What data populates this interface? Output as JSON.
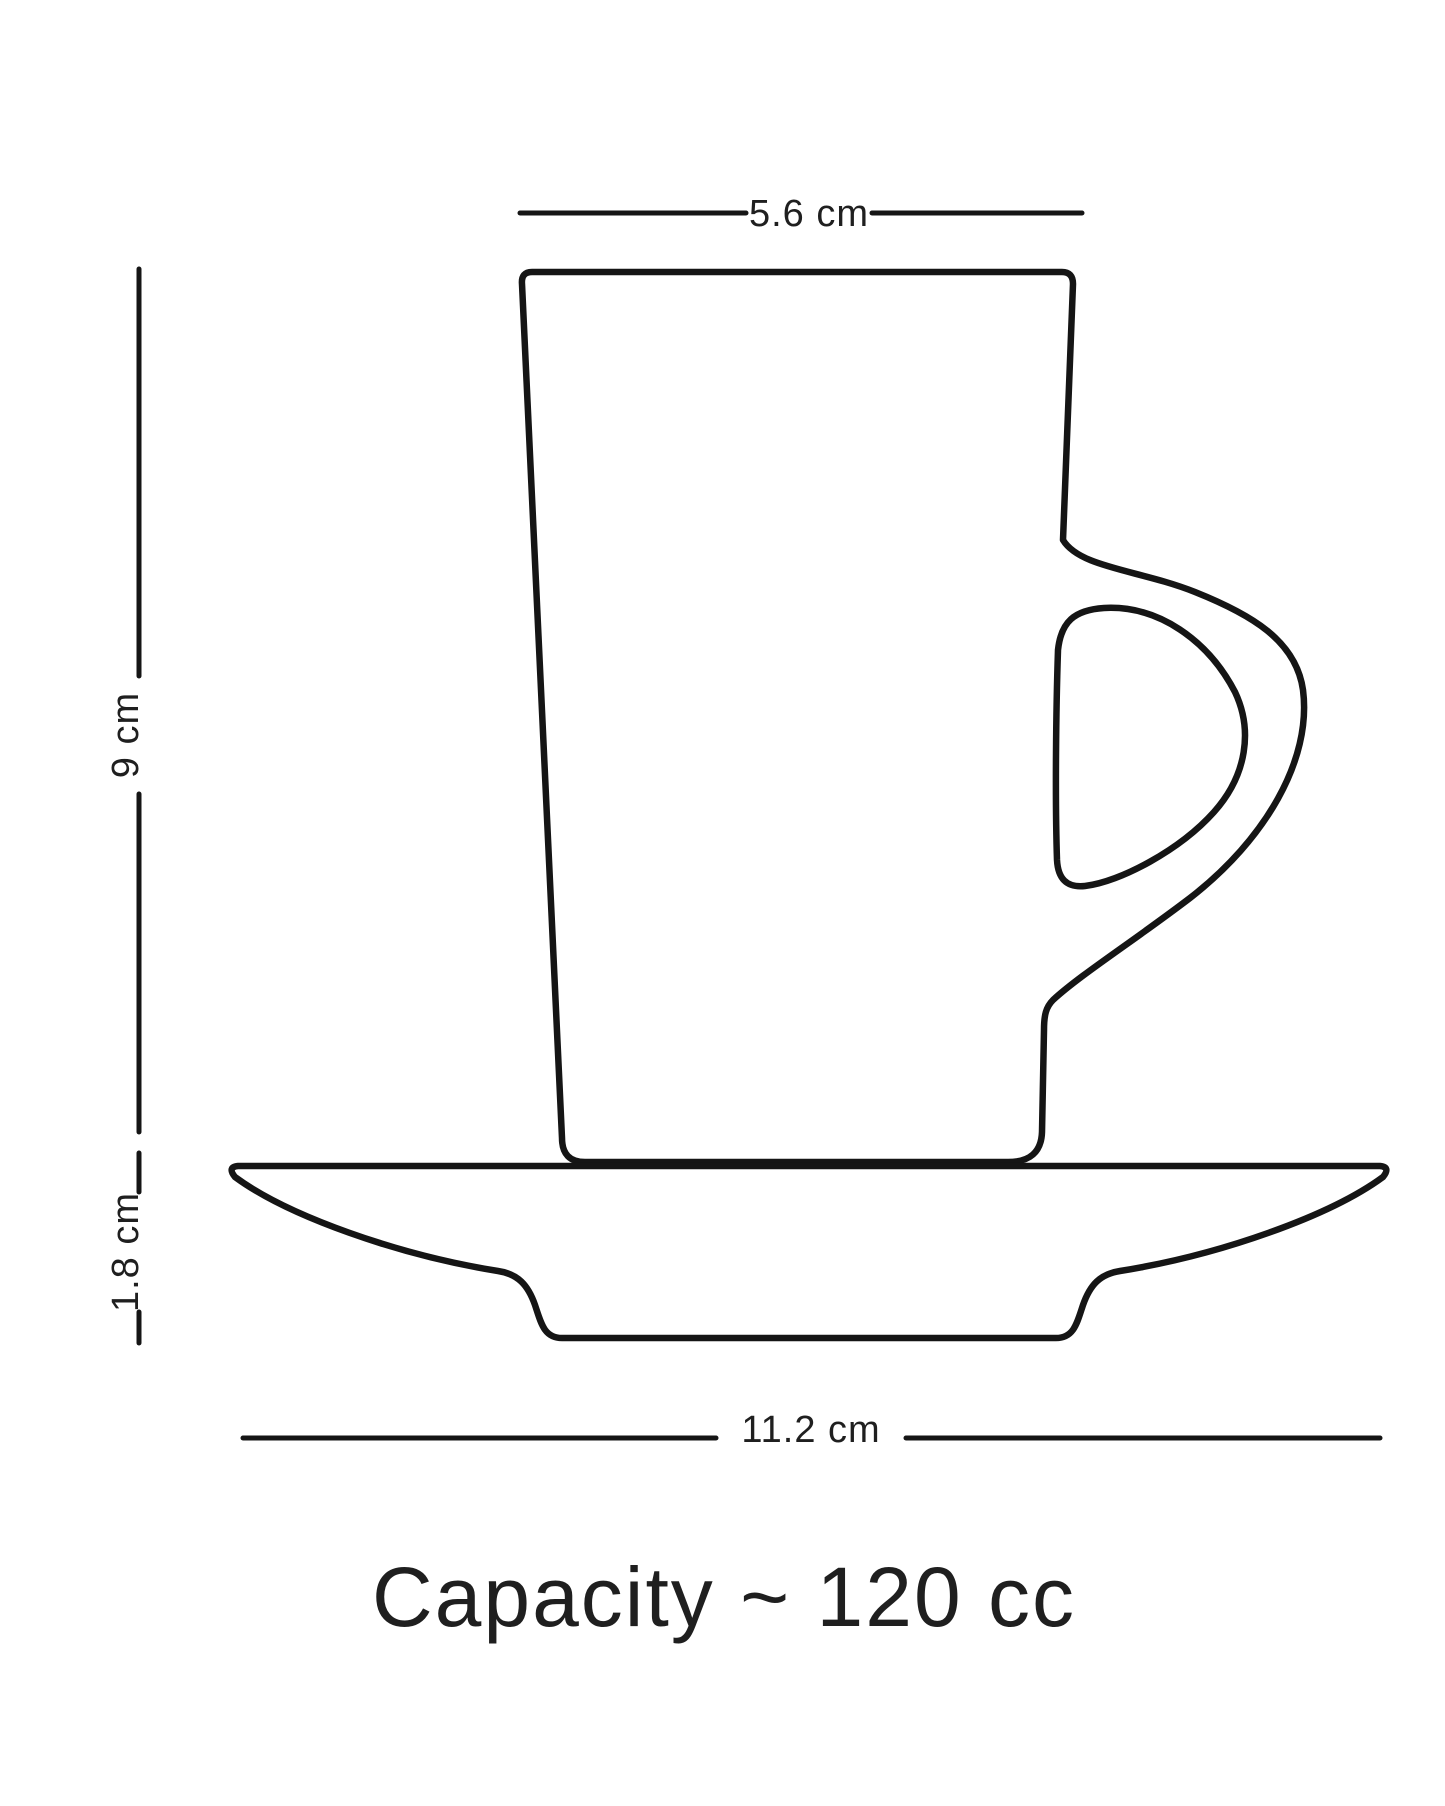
{
  "page": {
    "background": "#ffffff"
  },
  "diagram": {
    "type": "product-dimension-drawing",
    "subject": "espresso cup with saucer",
    "labels": {
      "cup_width": "5.6 cm",
      "cup_height": "9 cm",
      "saucer_height": "1.8 cm",
      "saucer_width": "11.2 cm"
    },
    "caption": "Capacity ~ 120 cc",
    "colors": {
      "stroke": "#151515",
      "text": "#1f1f1f",
      "background": "#ffffff"
    }
  }
}
